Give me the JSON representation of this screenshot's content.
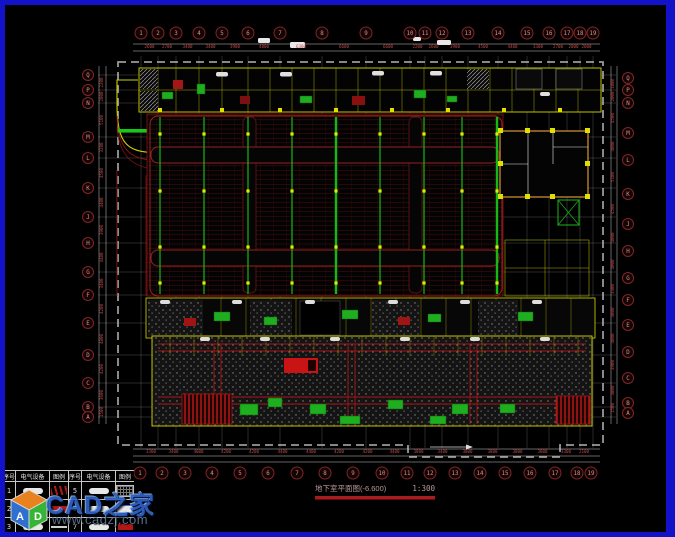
{
  "window": {
    "background": "#000000",
    "frame_color": "#1212c8"
  },
  "palette": {
    "grid_white": "#c8c8c8",
    "axis_bubble_red": "#7e2626",
    "stall_red": "#6d1212",
    "cable_green": "#16b816",
    "wall_yellow": "#c2c200",
    "hatch_gray": "#8a8a8a",
    "highlight_red": "#c81414",
    "dimension_red": "#c04848"
  },
  "title_block": {
    "title": "地下室平面图(-6.600)",
    "scale": "1:300"
  },
  "watermark": {
    "logo_text": "CAD之家",
    "url": "www.cadzj.com",
    "letters": {
      "left": "A",
      "right": "D"
    },
    "cube_colors": {
      "top": "#e8821e",
      "left": "#2f6fd0",
      "right": "#35b435"
    }
  },
  "legend": {
    "headers": [
      "序号",
      "电气设备",
      "图例",
      "序号",
      "电气设备",
      "图例"
    ],
    "rows": [
      {
        "no": "1",
        "device": "pill",
        "symbol": "red-glyph",
        "no2": "5",
        "device2": "pill",
        "symbol2": "hatch-box"
      },
      {
        "no": "2",
        "device": "green-box",
        "symbol": "red-bar",
        "no2": "6",
        "device2": "pill",
        "symbol2": "blue-pill"
      },
      {
        "no": "3",
        "device": "pill",
        "symbol": "dash",
        "no2": "7",
        "device2": "pill",
        "symbol2": "red-bar"
      },
      {
        "no": "4",
        "device": "red-bar",
        "symbol": "dash",
        "no2": "8",
        "device2": "pill",
        "symbol2": "dash"
      }
    ]
  },
  "grid": {
    "top": {
      "y": 33,
      "x": [
        141,
        158,
        176,
        199,
        222,
        248,
        280,
        322,
        366,
        410,
        425,
        442,
        468,
        498,
        527,
        549,
        567,
        580,
        593
      ],
      "labels": [
        "1",
        "2",
        "3",
        "4",
        "5",
        "6",
        "7",
        "8",
        "9",
        "10",
        "11",
        "12",
        "13",
        "14",
        "15",
        "16",
        "17",
        "18",
        "19"
      ]
    },
    "bottom": {
      "y": 473,
      "x": [
        140,
        162,
        185,
        212,
        240,
        268,
        297,
        325,
        353,
        382,
        407,
        430,
        455,
        480,
        505,
        530,
        555,
        577,
        591
      ],
      "labels": [
        "1",
        "2",
        "3",
        "4",
        "5",
        "6",
        "7",
        "8",
        "9",
        "10",
        "11",
        "12",
        "13",
        "14",
        "15",
        "16",
        "17",
        "18",
        "19"
      ]
    },
    "left": {
      "x": 88,
      "y": [
        75,
        90,
        103,
        137,
        158,
        188,
        217,
        243,
        272,
        295,
        323,
        355,
        383,
        407,
        417
      ],
      "labels": [
        "Q",
        "P",
        "N",
        "M",
        "L",
        "K",
        "J",
        "H",
        "G",
        "F",
        "E",
        "D",
        "C",
        "B",
        "A"
      ]
    },
    "right": {
      "x": 628,
      "y": [
        78,
        90,
        103,
        133,
        160,
        194,
        224,
        251,
        278,
        300,
        325,
        352,
        378,
        403,
        413
      ],
      "labels": [
        "Q",
        "P",
        "N",
        "M",
        "L",
        "K",
        "J",
        "H",
        "G",
        "F",
        "E",
        "D",
        "C",
        "B",
        "A"
      ]
    }
  },
  "dimensions": {
    "top": {
      "y": 48,
      "values": [
        "2600",
        "2700",
        "3400",
        "3400",
        "3900",
        "4800",
        "6300",
        "6600",
        "6600",
        "2200",
        "2600",
        "3900",
        "4500",
        "4400",
        "3300",
        "2700",
        "2000",
        "2000"
      ]
    },
    "bottom": {
      "y": 453,
      "values": [
        "3300",
        "3400",
        "4000",
        "4200",
        "4200",
        "4400",
        "4400",
        "4200",
        "4200",
        "4400",
        "3800",
        "3400",
        "3800",
        "3800",
        "3800",
        "3800",
        "3300",
        "2100"
      ]
    },
    "left": {
      "x": 103,
      "values": [
        "2200",
        "2000",
        "5100",
        "3200",
        "4500",
        "4400",
        "3900",
        "4400",
        "3400",
        "4200",
        "4800",
        "4200",
        "3600",
        "1500"
      ]
    },
    "right": {
      "x": 614,
      "values": [
        "1800",
        "2000",
        "4500",
        "4000",
        "5100",
        "4500",
        "4000",
        "4000",
        "3300",
        "3800",
        "4000",
        "3900",
        "3800",
        "1500"
      ]
    }
  }
}
